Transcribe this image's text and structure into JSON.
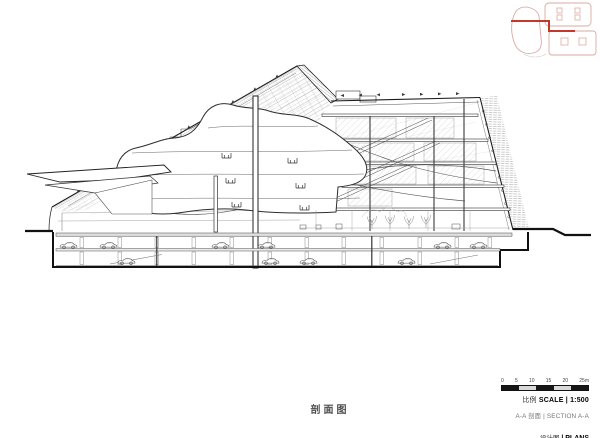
{
  "page": {
    "background": "#ffffff"
  },
  "colors": {
    "accent_red": "#c2392b",
    "key_plan_pink": "#dcaaa2",
    "line_dark": "#1c1c1c",
    "hatch_gray": "#a8a8a8",
    "scale_bar_dark": "#161616",
    "scale_bar_light": "#d8d8d8"
  },
  "drawing": {
    "title_cn": "剖面图"
  },
  "icons": {
    "key_plan": "site-key-plan-icon",
    "section_cut": "section-cut-line-icon",
    "cars": "parked-car-icon",
    "trees": "tree-icon"
  },
  "title_block": {
    "scale_bar_ticks": [
      "0",
      "5",
      "10",
      "15",
      "20",
      "25m"
    ],
    "scale_cn": "比例",
    "scale_en": "SCALE | 1:500",
    "section_cn": "A-A 剖面",
    "section_en": "| SECTION A-A",
    "sheet_cn": "设计图",
    "sheet_en": "| PLANS"
  }
}
